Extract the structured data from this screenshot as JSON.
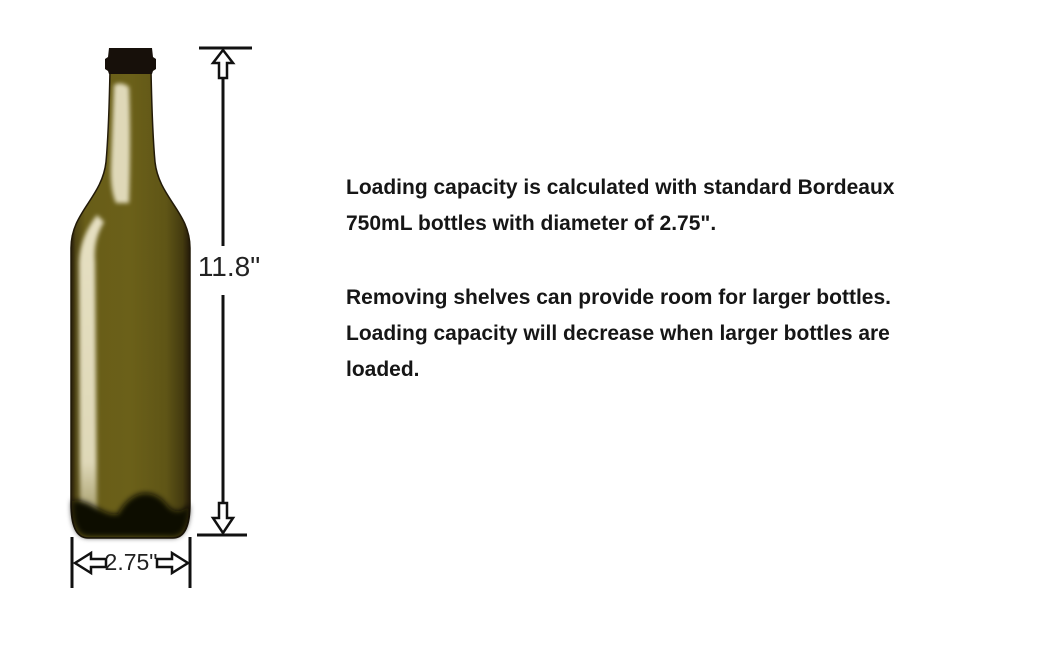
{
  "diagram": {
    "height_label": "11.8\"",
    "width_label": "2.75\""
  },
  "description": {
    "p1_lines": [
      "Loading capacity is calculated with standard Bordeaux",
      "750mL bottles with diameter of 2.75\"."
    ],
    "p2_lines": [
      "Removing shelves can provide room for larger bottles.",
      "Loading capacity will decrease when larger bottles are",
      "loaded."
    ]
  },
  "colors": {
    "background": "#ffffff",
    "glass_olive": "#6b6019",
    "glass_edge_dark": "#241a09",
    "glass_highlight": "#ece6ca",
    "cap_black": "#17100a",
    "base_shadow": "#0c0903",
    "dimension_line": "#111111",
    "text": "#161616"
  }
}
